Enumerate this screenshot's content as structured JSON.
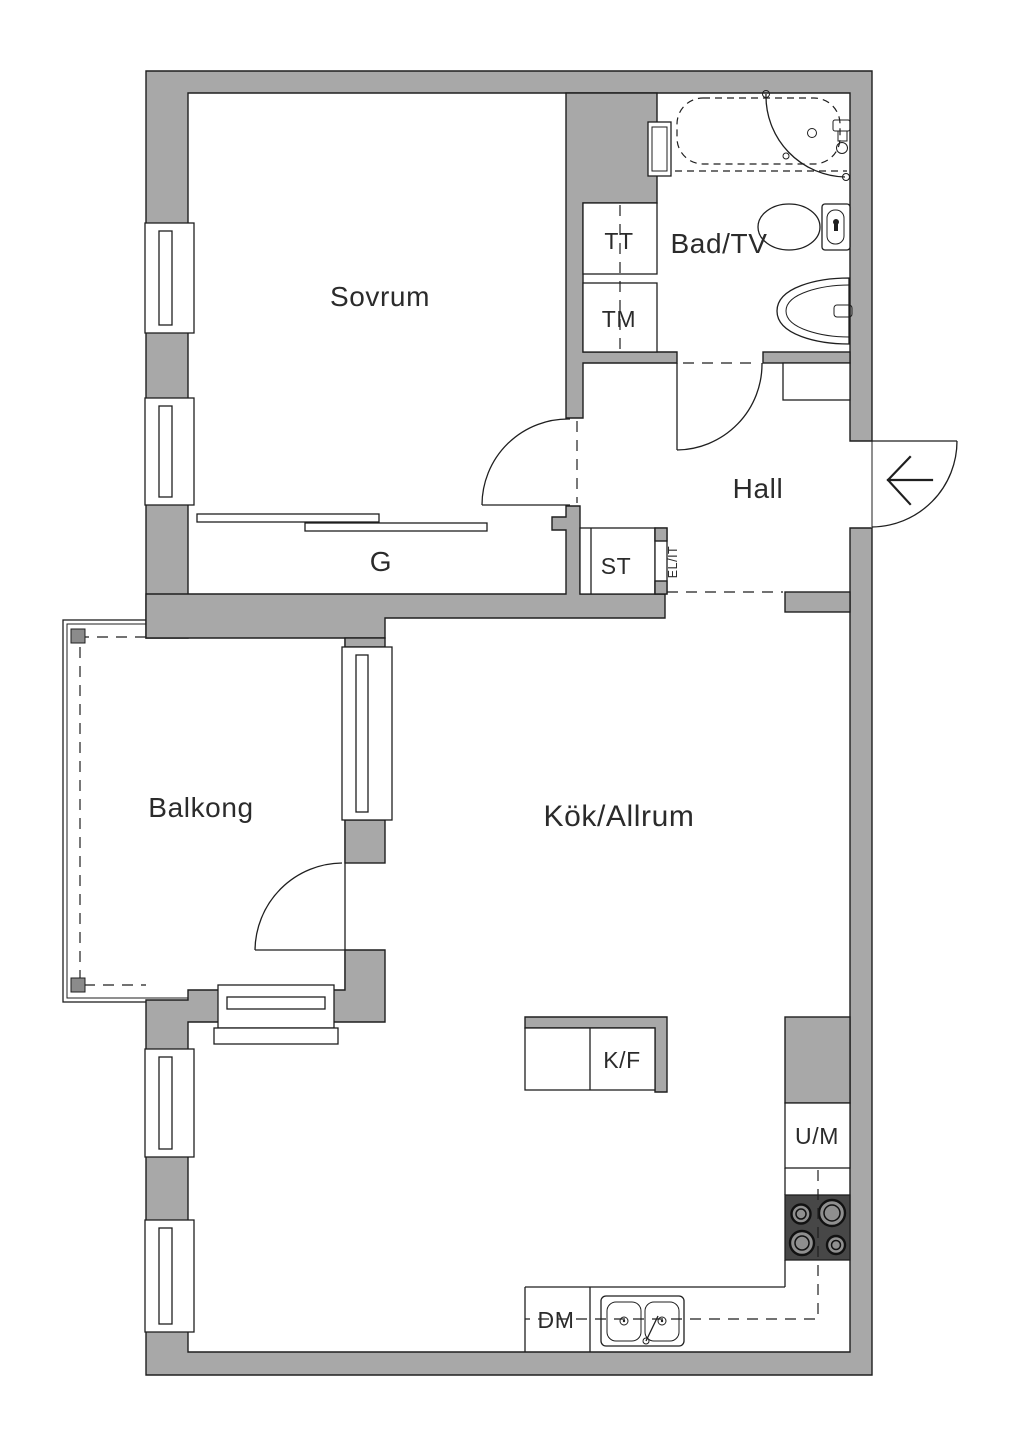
{
  "labels": {
    "bedroom": "Sovrum",
    "bathroom": "Bad/TV",
    "dryer": "TT",
    "washer": "TM",
    "hall": "Hall",
    "wardrobe": "G",
    "storage": "ST",
    "electrical": "EL/IT",
    "balcony": "Balkong",
    "kitchen_living": "Kök/Allrum",
    "fridge_freezer": "K/F",
    "oven_microwave": "U/M",
    "dishwasher": "DM"
  },
  "colors": {
    "wall": "#a8a8a8",
    "line": "#1f1f1f",
    "stove_top": "#474747",
    "burner": "#8f8f8f",
    "balcony_post": "#8b8b8b",
    "label_text": "#2b2b2b",
    "background": "#ffffff"
  }
}
